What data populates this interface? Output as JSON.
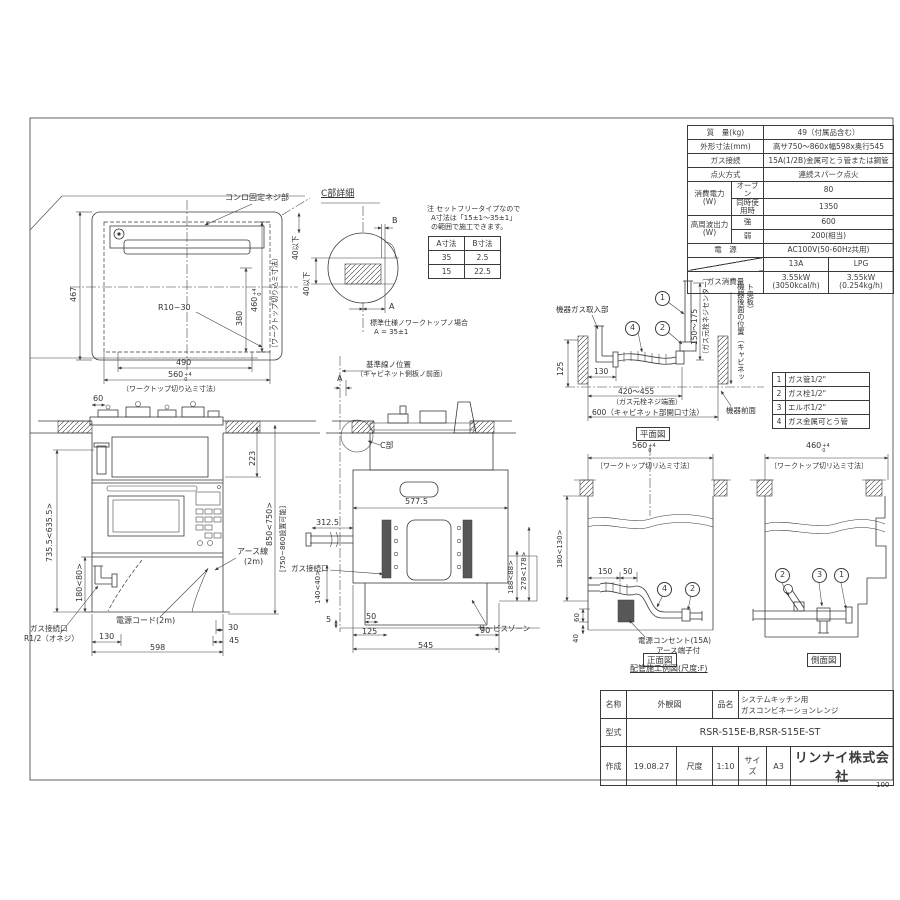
{
  "common": {
    "tol_top": "+4",
    "tol_bot": "0"
  },
  "cutout": {
    "screw_label": "コンロ固定ネジ部",
    "d467": "467",
    "r_label": "R10~30",
    "d380": "380",
    "d490": "490",
    "d560": "560",
    "d460": "460",
    "cut_note": "（ワークトップ切り込ミ寸法）",
    "max40": "40以下"
  },
  "detail_c": {
    "title": "C部詳細",
    "note1": "注 セットフリータイプなので",
    "note2": "A寸法は「15±1～35±1」",
    "note3": "の範囲で施工できます。",
    "col_a": "A寸法",
    "col_b": "B寸法",
    "r1a": "35",
    "r1b": "2.5",
    "r2a": "15",
    "r2b": "22.5",
    "max40": "40以下",
    "dim_b": "B",
    "dim_a": "A",
    "std1": "標準仕様ノワークトップノ場合",
    "std2": "A = 35±1"
  },
  "front": {
    "d60": "60",
    "d223": "223",
    "d735": "735.5<635.5>",
    "d180": "180<80>",
    "d850": "850<750>",
    "d850n": "[750~860設置可能]",
    "earth1": "アース線",
    "earth2": "(2m)",
    "cord": "電源コード(2m)",
    "gas1": "ガス接続口",
    "gas2": "R1/2（オネジ）",
    "d130": "130",
    "d598": "598",
    "d30": "30",
    "d45": "45"
  },
  "sidev": {
    "ref1": "基準線ノ位置",
    "ref2": "（キャビネット側板ノ前面）",
    "a": "A",
    "c": "C部",
    "d5775": "577.5",
    "d3125": "312.5",
    "gas": "ガス接続口",
    "d140": "140<40>",
    "d5": "5",
    "d50": "50",
    "d125": "125",
    "d545": "545",
    "d90": "90",
    "d188": "188<88>",
    "d278": "278<178>",
    "service": "サービスゾーン"
  },
  "plan": {
    "intake": "機器ガス取入部",
    "d150": "150～175",
    "center_note": "（ガス元栓ネジセンター）",
    "d125": "125",
    "d130": "130",
    "d420": "420～455",
    "end_note": "（ガス元栓ネジ端面）",
    "d600": "600（キャビネット部開口寸法）",
    "front_face": "機器前面",
    "back_note": "機器後面の位置（キャビネット奥板）",
    "caption": "平面図",
    "b1": "1",
    "b2": "2",
    "b4": "4"
  },
  "parts": [
    {
      "no": "1",
      "name": "ガス管1/2\""
    },
    {
      "no": "2",
      "name": "ガス栓1/2\""
    },
    {
      "no": "3",
      "name": "エルボ1/2\""
    },
    {
      "no": "4",
      "name": "ガス金属可とう管"
    }
  ],
  "pfront": {
    "d560": "560",
    "note": "〔ワークトップ切リ込ミ寸法〕",
    "d180": "180<130>",
    "d150": "150",
    "d50": "50",
    "d60": "60",
    "d40": "40",
    "outlet1": "電源コンセント(15A)",
    "outlet2": "アース端子付",
    "caption": "正面図",
    "b4": "4",
    "b2": "2"
  },
  "pside": {
    "d460": "460",
    "note": "〔ワークトップ切リ込ミ寸法〕",
    "caption": "側面図",
    "b2": "2",
    "b3": "3",
    "b1": "1"
  },
  "example_label": "配管施工例図(尺度:F)",
  "spec": {
    "r1l": "質　量(kg)",
    "r1v": "49（付属品含む）",
    "r2l": "外形寸法(mm)",
    "r2v": "高サ750～860x幅598x奥行545",
    "r3l": "ガス接続",
    "r3v": "15A(1/2B)金属可とう管または鋼管",
    "r4l": "点火方式",
    "r4v": "連続スパーク点火",
    "r5l": "消費電力",
    "r5l2": "(W)",
    "r5a": "オーブン",
    "r5av": "80",
    "r5b": "同時使用時",
    "r5bv": "1350",
    "r6l": "高周波出力",
    "r6l2": "(W)",
    "r6a": "強",
    "r6av": "600",
    "r6b": "弱",
    "r6bv": "200(相当)",
    "r7l": "電　源",
    "r7v": "AC100V(50-60Hz共用)",
    "g13": "13A",
    "glp": "LPG",
    "r9l": "ガス消費量",
    "kw13": "3.55kW",
    "kcal13": "(3050kcal/h)",
    "kwlp": "3.55kW",
    "kglp": "(0.254kg/h)"
  },
  "titleblock": {
    "name_l": "名称",
    "name_v": "外観図",
    "pname_l": "品名",
    "pname1": "システムキッチン用",
    "pname2": "ガスコンビネーションレンジ",
    "model_l": "型式",
    "model_v": "RSR-S15E-B,RSR-S15E-ST",
    "date_l": "作成",
    "date_v": "19.08.27",
    "scale_l": "尺度",
    "scale_v": "1:10",
    "size_l": "サイズ",
    "size_v": "A3",
    "company": "リンナイ株式会社"
  },
  "page_no": "100"
}
